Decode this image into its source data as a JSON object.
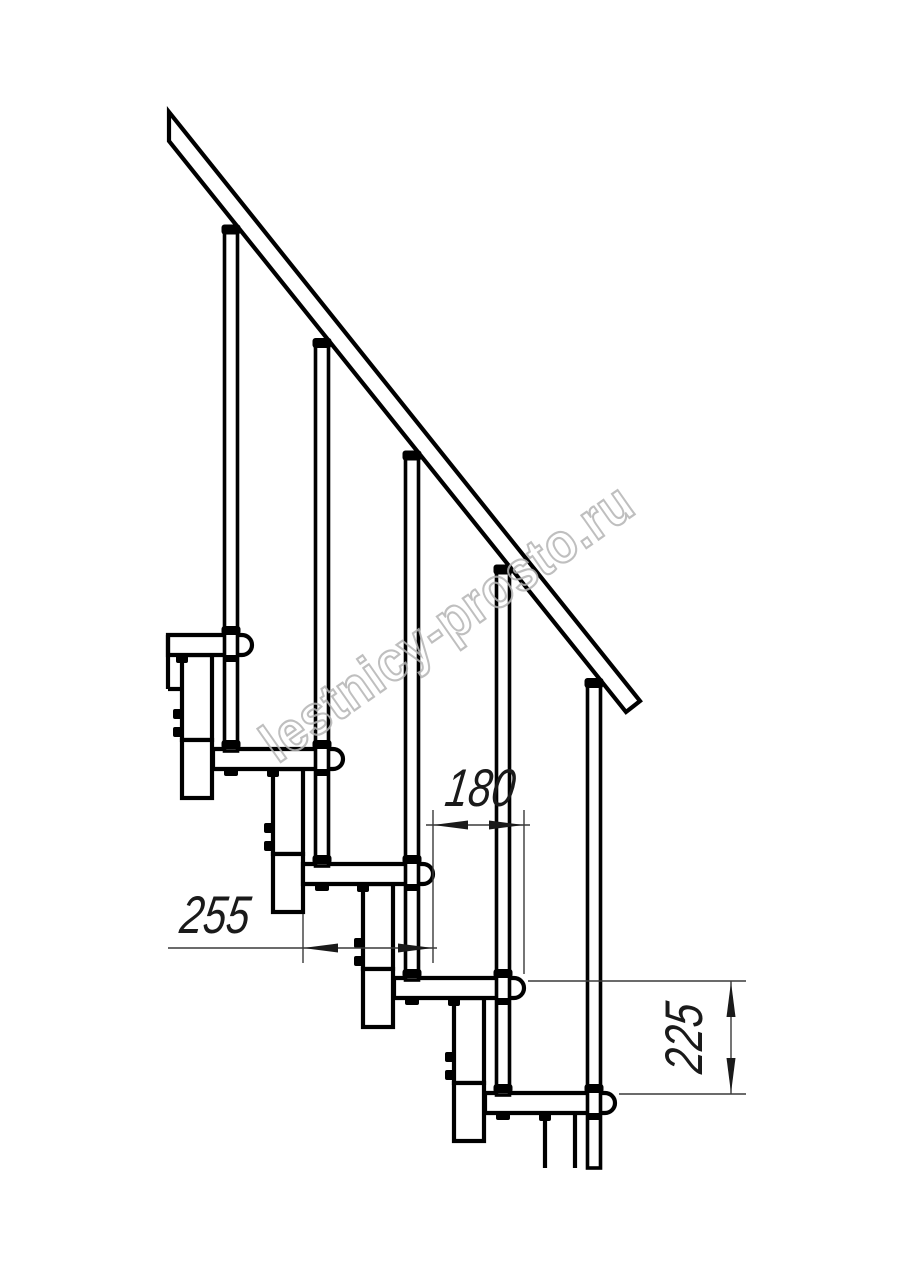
{
  "drawing": {
    "title": "staircase-fragment-side-view",
    "watermark": "lestnicy-prosto.ru",
    "dimensions": {
      "run_label": "180",
      "tread_depth_label": "255",
      "rise_label": "225"
    },
    "colors": {
      "line": "#000000",
      "dimension": "#3a3a3a",
      "watermark": "#b4b4b4",
      "background": "#ffffff"
    }
  }
}
